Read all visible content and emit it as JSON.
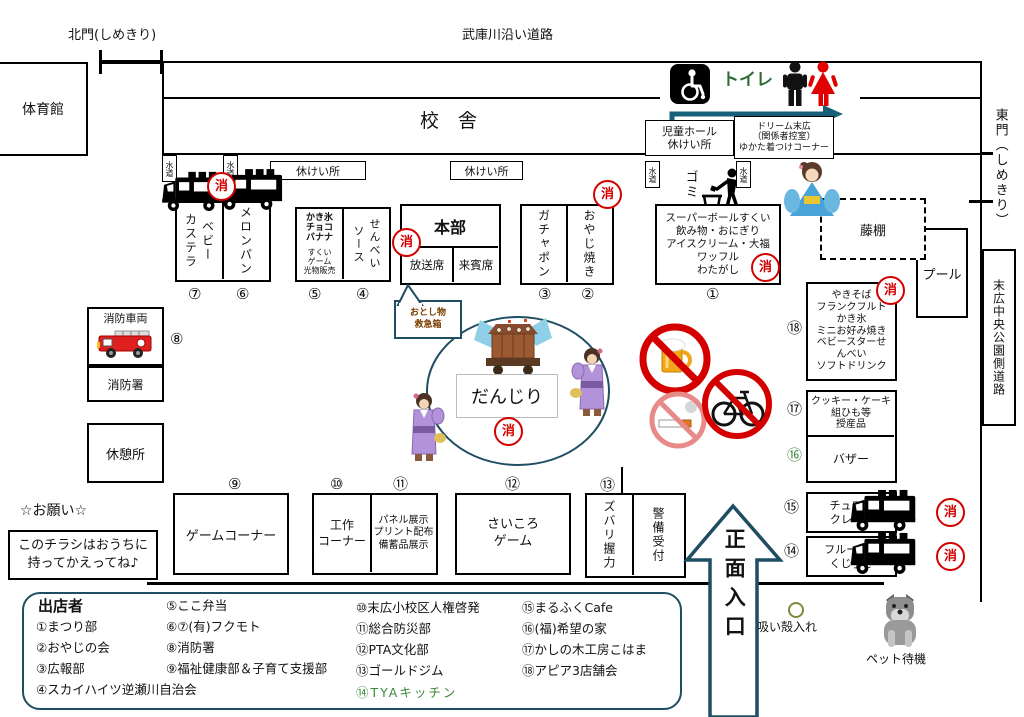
{
  "colors": {
    "accent_navy": "#1f4e63",
    "fire_red": "#d40000",
    "toilet_green": "#2f6b35",
    "legend_green": "#3c8a3c",
    "arrow_teal": "#17607a"
  },
  "labels": {
    "north_gate": "北門(しめきり)",
    "top_road": "武庫川沿い道路",
    "east_gate": "東門（しめきり）",
    "side_road": "末広中央公園側道路",
    "gym": "体育館",
    "school": "校　舎",
    "pool": "プール",
    "pergola": "藤棚",
    "toilet": "トイレ",
    "kids_hall": "児童ホール\n休けい所",
    "dressing_room": "ドリーム末広\n（関係者控室）\nゆかた着つけコーナー",
    "trash": "ゴミ",
    "water": "水道",
    "rest_area": "休けい所",
    "fire_mark": "消",
    "lost_found": "おとし物\n救急箱",
    "danjiri": "だんじり",
    "fire_vehicle": "消防車両",
    "fire_dept": "消防署",
    "rest_house": "休憩所",
    "security": "警備受付",
    "main_entrance": "正面入口",
    "request_title": "☆お願い☆",
    "request_note": "このチラシはおうちに\n持ってかえってね♪",
    "ashtray": "吸い殻入れ",
    "pet_waiting": "ペット待機"
  },
  "booths": {
    "b1": {
      "no": "①",
      "label": "スーパーボールすくい\n飲み物・おにぎり\nアイスクリーム・大福\nワッフル\nわたがし"
    },
    "b2": {
      "no": "②",
      "label": "おやじ焼き"
    },
    "b3": {
      "no": "③",
      "label": "ガチャポン"
    },
    "b4": {
      "no": "④",
      "label": "ソース\nせんべい"
    },
    "b5": {
      "no": "⑤",
      "label_top": "かき氷\nチョコ\nバナナ",
      "label_bottom": "すくい\nゲーム\n光物販売"
    },
    "b6": {
      "no": "⑥",
      "label": "メロンパン"
    },
    "b7": {
      "no": "⑦",
      "label": "ベビー\nカステラ"
    },
    "b8": {
      "no": "⑧"
    },
    "b9": {
      "no": "⑨",
      "label": "ゲームコーナー"
    },
    "b10": {
      "no": "⑩",
      "label": "工作\nコーナー"
    },
    "b11": {
      "no": "⑪",
      "label": "パネル展示\nプリント配布\n備蓄品展示"
    },
    "b12": {
      "no": "⑫",
      "label": "さいころ\nゲーム"
    },
    "b13": {
      "no": "⑬",
      "label": "ズバリ握力"
    },
    "b14": {
      "no": "⑭",
      "label": "フルーツ飴\nくじ引き"
    },
    "b15": {
      "no": "⑮",
      "label": "チュロス\nクレープ"
    },
    "b16": {
      "no": "⑯",
      "label": "バザー"
    },
    "b17": {
      "no": "⑰",
      "label": "クッキー・ケーキ\n組ひも等\n授産品"
    },
    "b18": {
      "no": "⑱",
      "label": "やきそば\nフランクフルト\nかき氷\nミニお好み焼き\nベビースターせ\nんべい\nソフトドリンク"
    },
    "hq": {
      "label": "本部",
      "sub_left": "放送席",
      "sub_right": "来賓席"
    }
  },
  "legend": {
    "title": "出店者",
    "col1": [
      "①まつり部",
      "②おやじの会",
      "③広報部",
      "④スカイハイツ逆瀬川自治会"
    ],
    "col2": [
      "⑤ここ弁当",
      "⑥⑦(有)フクモト",
      "⑧消防署",
      "⑨福祉健康部＆子育て支援部"
    ],
    "col3": [
      "⑩末広小校区人権啓発",
      "⑪総合防災部",
      "⑫PTA文化部",
      "⑬ゴールドジム",
      "⑭TYAキッチン"
    ],
    "col4": [
      "⑮まるふくCafe",
      "⑯(福)希望の家",
      "⑰かしの木工房こはま",
      "⑱アピア3店舗会"
    ]
  },
  "icons": {
    "wheelchair": "♿",
    "men_restroom": "man-silhouette",
    "women_restroom": "woman-silhouette",
    "litter_disposal": "person-throwing-trash",
    "kitchen_car": "black-food-truck",
    "fire_engine": "red-fire-truck",
    "no_alcohol": "beer-mug-prohibition",
    "no_smoking": "cigarette-prohibition",
    "no_bicycle": "bicycle-prohibition",
    "danjiri_float": "festival-float",
    "yukata_girl": "girl-in-purple-yukata",
    "kimono_woman": "woman-in-blue-kimono",
    "dog": "gray-waiting-dog",
    "ashtray_circle": "small-circle"
  }
}
